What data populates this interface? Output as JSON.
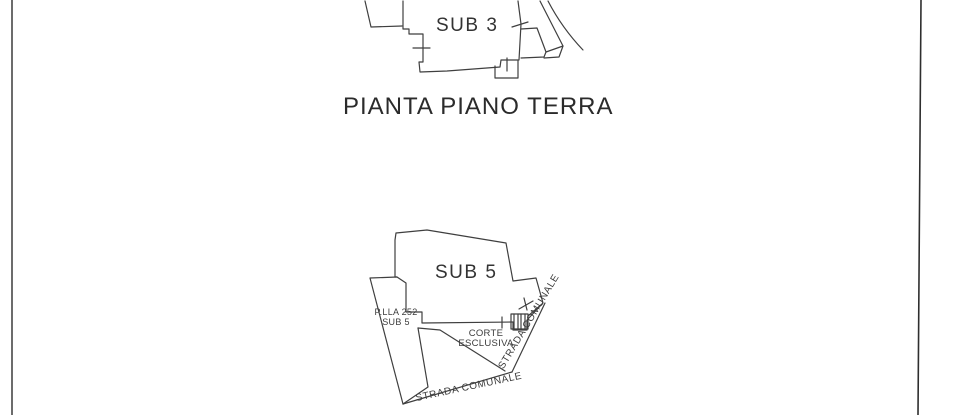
{
  "title": "PIANTA PIANO TERRA",
  "labels": {
    "sub3": "SUB 3",
    "sub5": "SUB 5",
    "parcel_line1": "P.LLA 252",
    "parcel_line2": "SUB 5",
    "corte_line1": "CORTE",
    "corte_line2": "ESCLUSIVA",
    "road_bottom": "STRADA COMUNALE",
    "road_right": "STRADA COMUNALE"
  },
  "colors": {
    "ink": "#3f3f3f",
    "text": "#2b2b2b",
    "background": "#ffffff"
  }
}
